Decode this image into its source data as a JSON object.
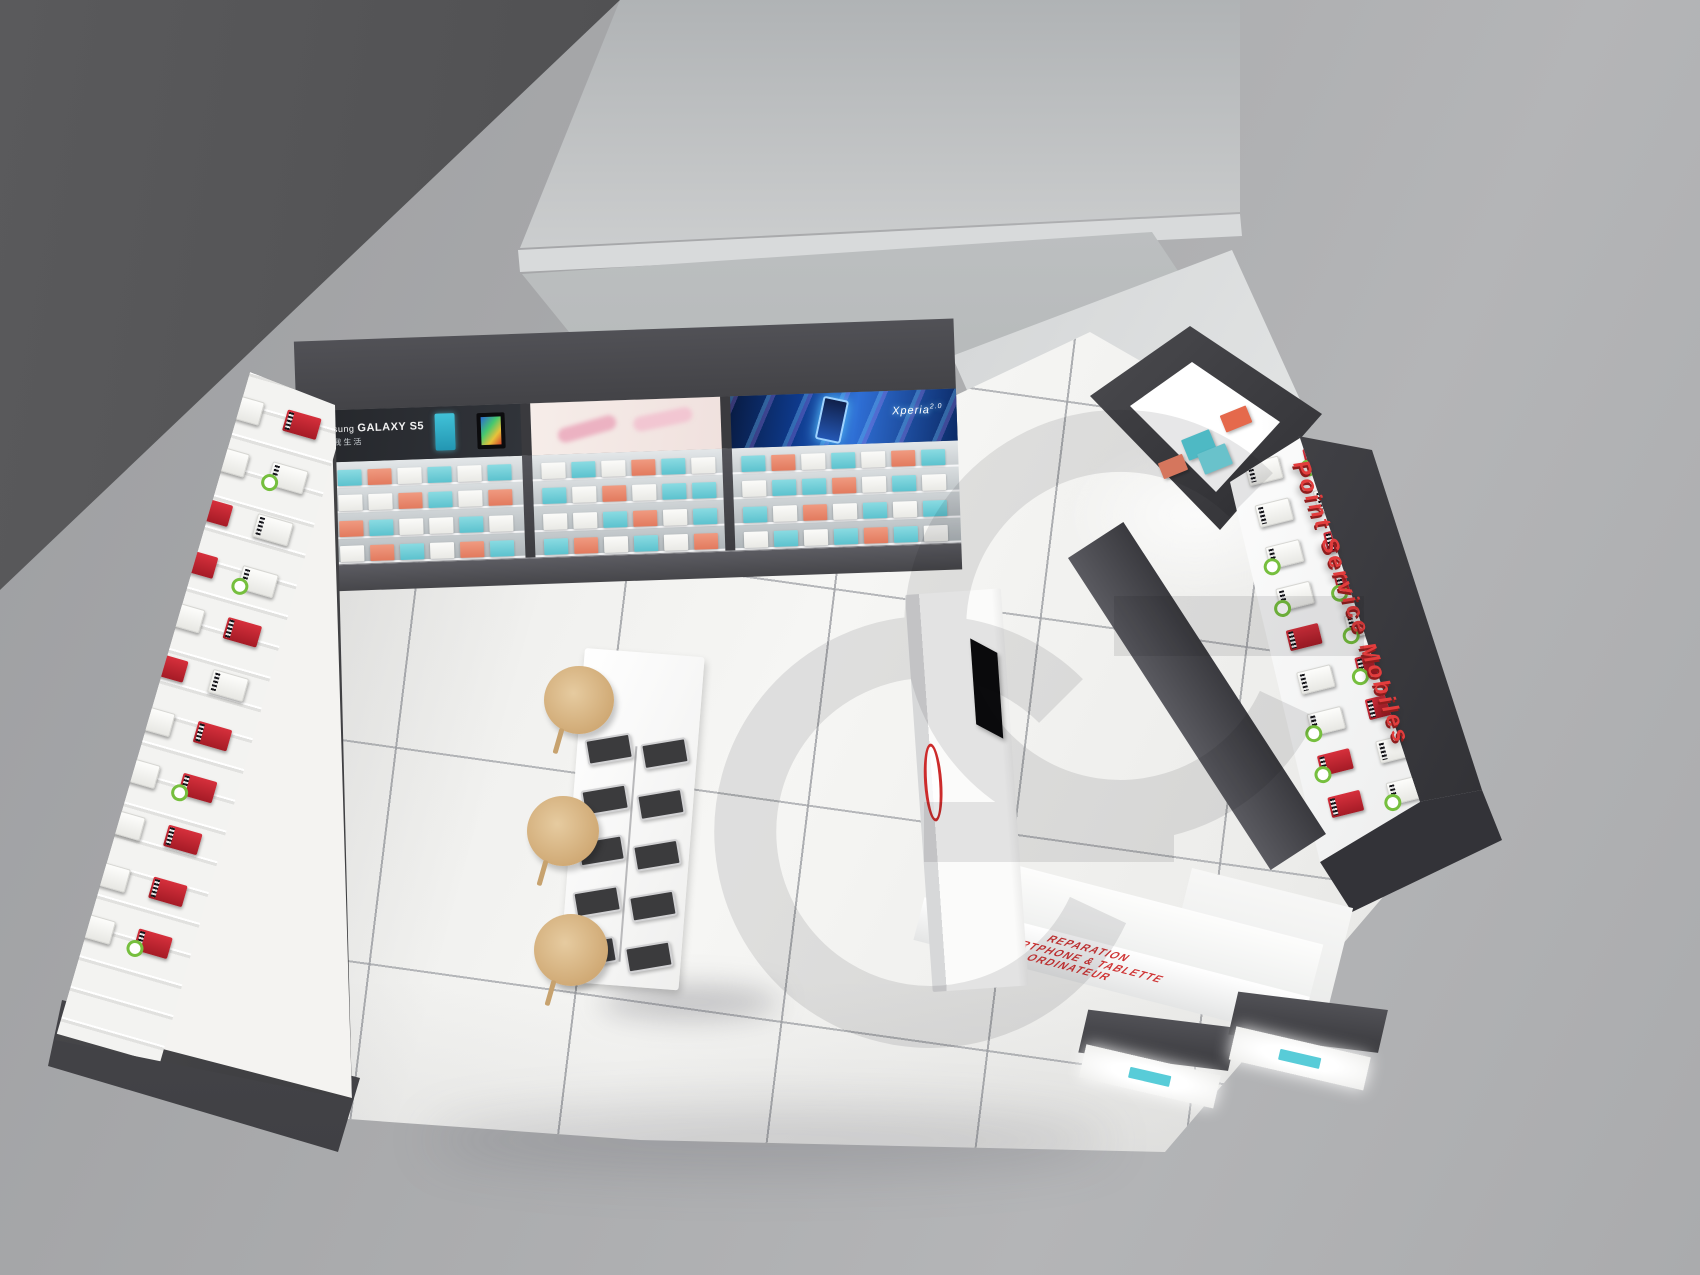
{
  "banners": {
    "samsung_brand": "Samsung",
    "samsung_model": "GALAXY S5",
    "samsung_tagline": "点亮我生活",
    "xperia_brand": "Xperia",
    "xperia_version": "2.0"
  },
  "signage": {
    "service_sign": "Point Service Mobiles"
  },
  "counter": {
    "front_lines": [
      "REPARATION",
      "SMARTPHONE & TABLETTE",
      "ORDINATEUR"
    ]
  },
  "icons": {
    "watermark": "gc-monogram-watermark",
    "counter_logo": "red-ring-logo"
  },
  "colors": {
    "accent_red": "#d23333",
    "sign_red": "#e23d3d",
    "teal_box": "#5cc2ce",
    "coral_box": "#e27a5e",
    "red_box": "#c4232e",
    "badge_green": "#76bf3e",
    "wood": "#d8bb8e",
    "dark_wall": "#4a4a4c",
    "floor": "#f2f2f0",
    "backdrop": "#a8a9ab"
  },
  "shelves": {
    "bay1": [
      [
        "w",
        "t",
        "c",
        "w",
        "t",
        "w",
        "t"
      ],
      [
        "t",
        "w",
        "w",
        "c",
        "t",
        "w",
        "c"
      ],
      [
        "w",
        "c",
        "t",
        "w",
        "w",
        "t",
        "w"
      ],
      [
        "t",
        "w",
        "c",
        "t",
        "w",
        "c",
        "t"
      ]
    ],
    "bay2": [
      [
        "w",
        "t",
        "w",
        "c",
        "t",
        "w"
      ],
      [
        "t",
        "w",
        "c",
        "w",
        "t",
        "t"
      ],
      [
        "w",
        "w",
        "t",
        "c",
        "w",
        "t"
      ],
      [
        "t",
        "c",
        "w",
        "t",
        "w",
        "c"
      ]
    ],
    "bay3": [
      [
        "t",
        "c",
        "w",
        "t",
        "w",
        "c",
        "t"
      ],
      [
        "w",
        "t",
        "t",
        "c",
        "w",
        "t",
        "w"
      ],
      [
        "t",
        "w",
        "c",
        "w",
        "t",
        "w",
        "t"
      ],
      [
        "w",
        "t",
        "w",
        "t",
        "c",
        "t",
        "w"
      ]
    ]
  },
  "left_wall": {
    "boxes": [
      "wr b",
      "rd",
      "wr",
      "wr b",
      "rd b",
      "wr",
      "rd",
      "wr b",
      "wr",
      "rd",
      "rd b",
      "wr",
      "wr b",
      "rd",
      "wr",
      "rd b",
      "wr b",
      "rd",
      "wr",
      "rd",
      "wr b",
      "rd b"
    ]
  },
  "right_wall": {
    "boxes": [
      "wr",
      "rd b",
      "wr b",
      "wr",
      "wr",
      "rd",
      "wr b",
      "rd",
      "wr",
      "wr b",
      "rd b",
      "wr",
      "rd",
      "wr b",
      "wr",
      "wr",
      "rd b",
      "wr",
      "wr b",
      "rd",
      "wr",
      "rd b",
      "wr",
      "wr b",
      "rd",
      "wr b",
      "wr"
    ]
  },
  "cabinet": {
    "boxes": [
      "coral",
      "teal",
      "teal",
      "coral"
    ]
  },
  "table": {
    "devices": [
      "ph",
      "ph",
      "ph",
      "ph",
      "ph",
      "ph",
      "ph",
      "ph",
      "ph",
      "ph"
    ]
  }
}
